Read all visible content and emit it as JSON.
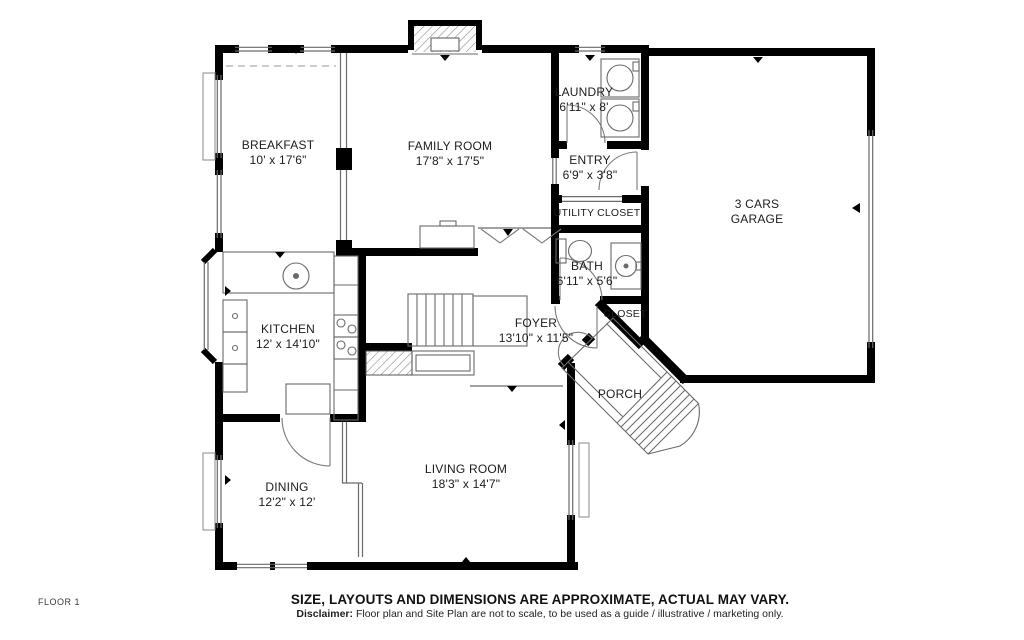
{
  "floor_label": "FLOOR 1",
  "rooms": [
    {
      "name": "BREAKFAST",
      "dims": "10' x 17'6\""
    },
    {
      "name": "FAMILY ROOM",
      "dims": "17'8\" x 17'5\""
    },
    {
      "name": "LAUNDRY",
      "dims": "6'11\" x 8'"
    },
    {
      "name": "ENTRY",
      "dims": "6'9\" x 3'8\""
    },
    {
      "name": "UTILITY CLOSET"
    },
    {
      "name": "BATH",
      "dims": "6'11\" x 5'6\""
    },
    {
      "name": "3 CARS",
      "name2": "GARAGE"
    },
    {
      "name": "KITCHEN",
      "dims": "12' x 14'10\""
    },
    {
      "name": "FOYER",
      "dims": "13'10\" x 11'5\""
    },
    {
      "name": "CLOSET"
    },
    {
      "name": "PORCH"
    },
    {
      "name": "DINING",
      "dims": "12'2\" x 12'"
    },
    {
      "name": "LIVING ROOM",
      "dims": "18'3\" x 14'7\""
    }
  ],
  "footer": {
    "headline": "SIZE, LAYOUTS AND DIMENSIONS ARE APPROXIMATE, ACTUAL MAY VARY.",
    "disclaimer_label": "Disclaimer:",
    "disclaimer_text": "Floor plan and Site Plan are not to scale, to be used as a guide / illustrative / marketing only."
  },
  "colors": {
    "walls": "#000000",
    "thin_lines": "#6a6a6a",
    "text": "#1c1c1c"
  }
}
